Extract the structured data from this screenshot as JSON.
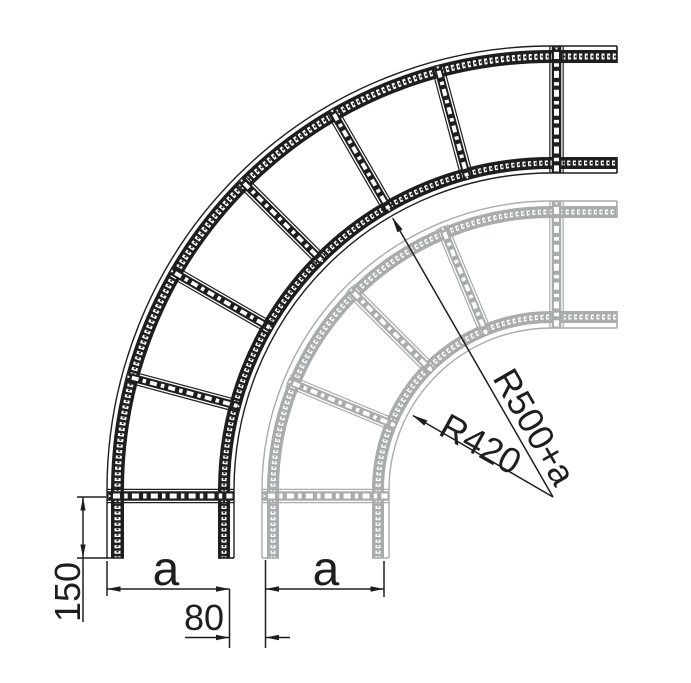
{
  "drawing": {
    "description": "Top view technical drawing of a 90 degree cable ladder bend, front variant in black overlaid with smaller back variant in gray",
    "background_color": "#ffffff",
    "front_ladder_color": "#1e1e1e",
    "back_ladder_color": "#a9acac",
    "slot_color": "#ffffff"
  },
  "dimensions": {
    "tail_length": "150",
    "width_front": "a",
    "width_back": "a",
    "offset": "80",
    "radius_front": "R500+a",
    "radius_back": "R420"
  }
}
